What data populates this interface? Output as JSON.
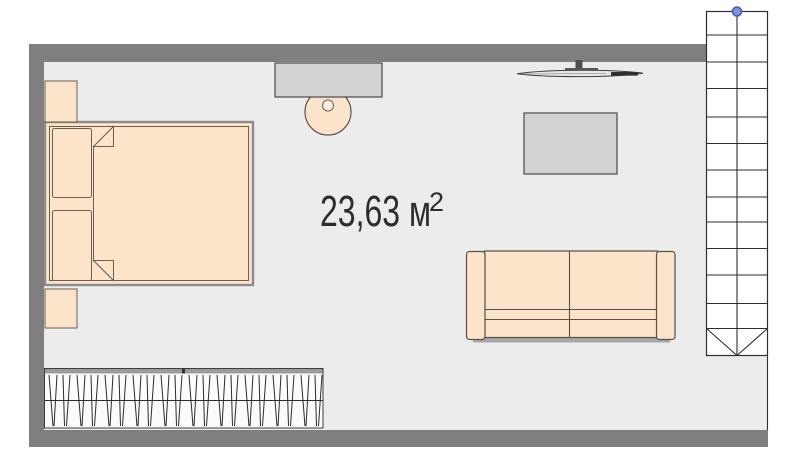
{
  "room": {
    "area_label": "23,63 м",
    "area_superscript": "2"
  },
  "stairs": {
    "visible_steps": 13,
    "marker": "blue-handle"
  },
  "furniture": [
    "bed",
    "pillows",
    "nightstands",
    "wardrobe-with-hangers",
    "desk",
    "stool",
    "tv",
    "table",
    "sofa",
    "stairs"
  ],
  "palette": {
    "background": "#ffffff",
    "wall": "#7f7f7f",
    "floor": "#ececec",
    "furniture_fill": "#fce4ca",
    "furniture_fill_light": "#fdf0e2",
    "furniture_outline": "#6b5f51",
    "frame_outline": "#8c8c8c",
    "sofa_outline": "#55504a",
    "surface_fill": "#d2d2d2",
    "surface_outline": "#4a4a4a",
    "hatch_line": "#2a2a2a",
    "stairs_line": "#2e2e2e",
    "marker_fill": "#7b96d6",
    "marker_stroke": "#3a5cb4",
    "shadow": "#a7a7a7",
    "wardrobe_strip": "#9b9b9b",
    "tv_screen": "#e6e6e6",
    "tv_dark": "#2f2f2f",
    "text": "#2d2d2d"
  }
}
